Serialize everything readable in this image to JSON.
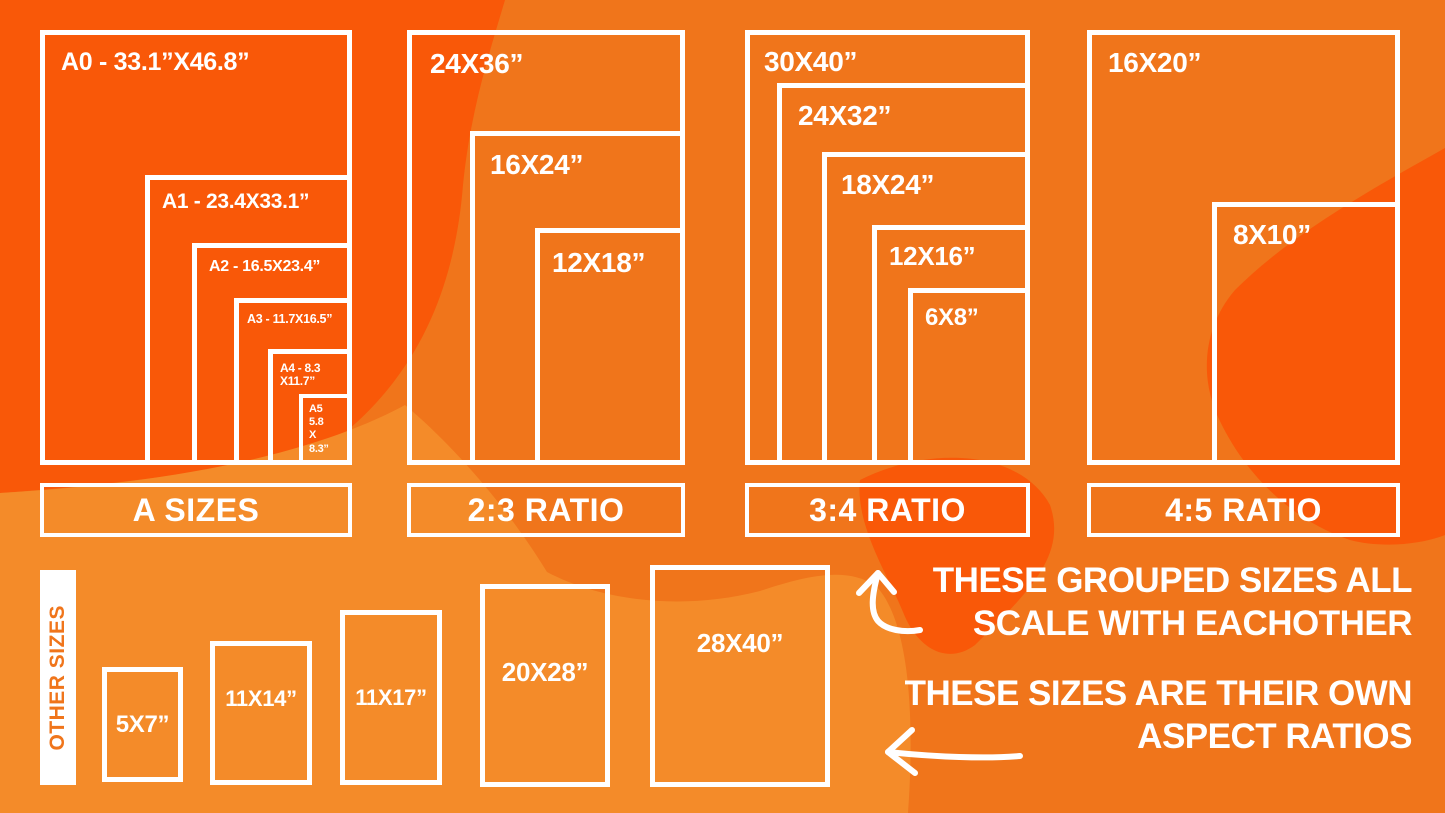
{
  "colors": {
    "bright": "#F95808",
    "base": "#F0751B",
    "light": "#F48B29",
    "line": "#FFFFFF"
  },
  "groups": [
    {
      "label": "A SIZES",
      "sizes": [
        {
          "label": "A0 - 33.1”X46.8”"
        },
        {
          "label": "A1 - 23.4X33.1”"
        },
        {
          "label": "A2 - 16.5X23.4”"
        },
        {
          "label": "A3 - 11.7X16.5”"
        },
        {
          "label": "A4 - 8.3\nX11.7”"
        },
        {
          "label": "A5\n5.8\nX\n8.3”"
        }
      ]
    },
    {
      "label": "2:3 RATIO",
      "sizes": [
        {
          "label": "24X36”"
        },
        {
          "label": "16X24”"
        },
        {
          "label": "12X18”"
        }
      ]
    },
    {
      "label": "3:4 RATIO",
      "sizes": [
        {
          "label": "30X40”"
        },
        {
          "label": "24X32”"
        },
        {
          "label": "18X24”"
        },
        {
          "label": "12X16”"
        },
        {
          "label": "6X8”"
        }
      ]
    },
    {
      "label": "4:5 RATIO",
      "sizes": [
        {
          "label": "16X20”"
        },
        {
          "label": "8X10”"
        }
      ]
    }
  ],
  "other": {
    "label": "OTHER SIZES",
    "sizes": [
      {
        "label": "5X7”"
      },
      {
        "label": "11X14”"
      },
      {
        "label": "11X17”"
      },
      {
        "label": "20X28”"
      },
      {
        "label": "28X40”"
      }
    ]
  },
  "annotations": {
    "grouped": "THESE GROUPED SIZES ALL\nSCALE WITH EACHOTHER",
    "own": "THESE SIZES ARE THEIR OWN\nASPECT RATIOS"
  }
}
